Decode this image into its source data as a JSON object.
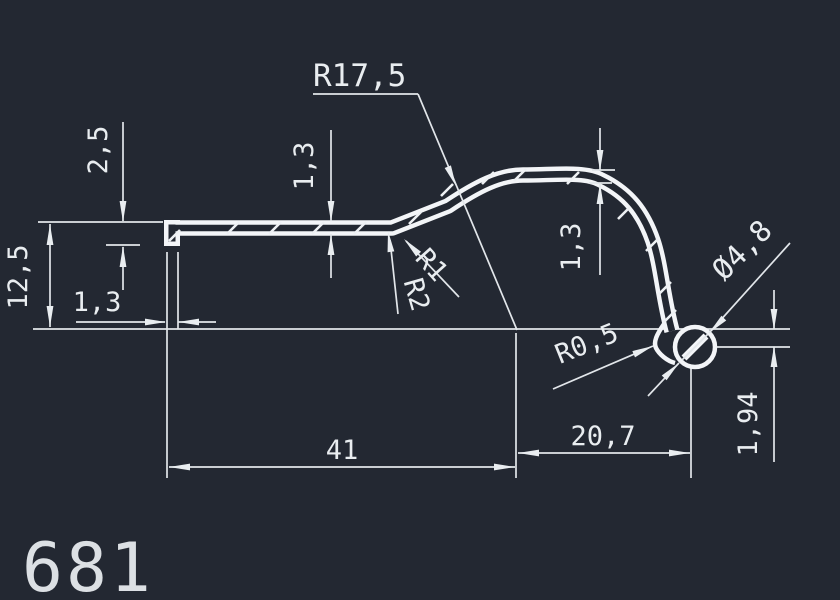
{
  "drawing": {
    "part_number": "681",
    "type_note": "extrusion profile cross-section",
    "colors": {
      "background": "#232832",
      "line": "#e9edf0"
    },
    "dimensions": {
      "lip_height": "2,5",
      "left_height": "12,5",
      "lip_thickness": "1,3",
      "wall_thickness_mid": "1,3",
      "wall_thickness_arc": "1,3",
      "main_radius": "R17,5",
      "fillet_r1": "R1",
      "fillet_r2": "R2",
      "fillet_r05": "R0,5",
      "bead_diameter": "Ø4,8",
      "length_main": "41",
      "length_bead": "20,7",
      "bead_offset": "1,94"
    }
  }
}
